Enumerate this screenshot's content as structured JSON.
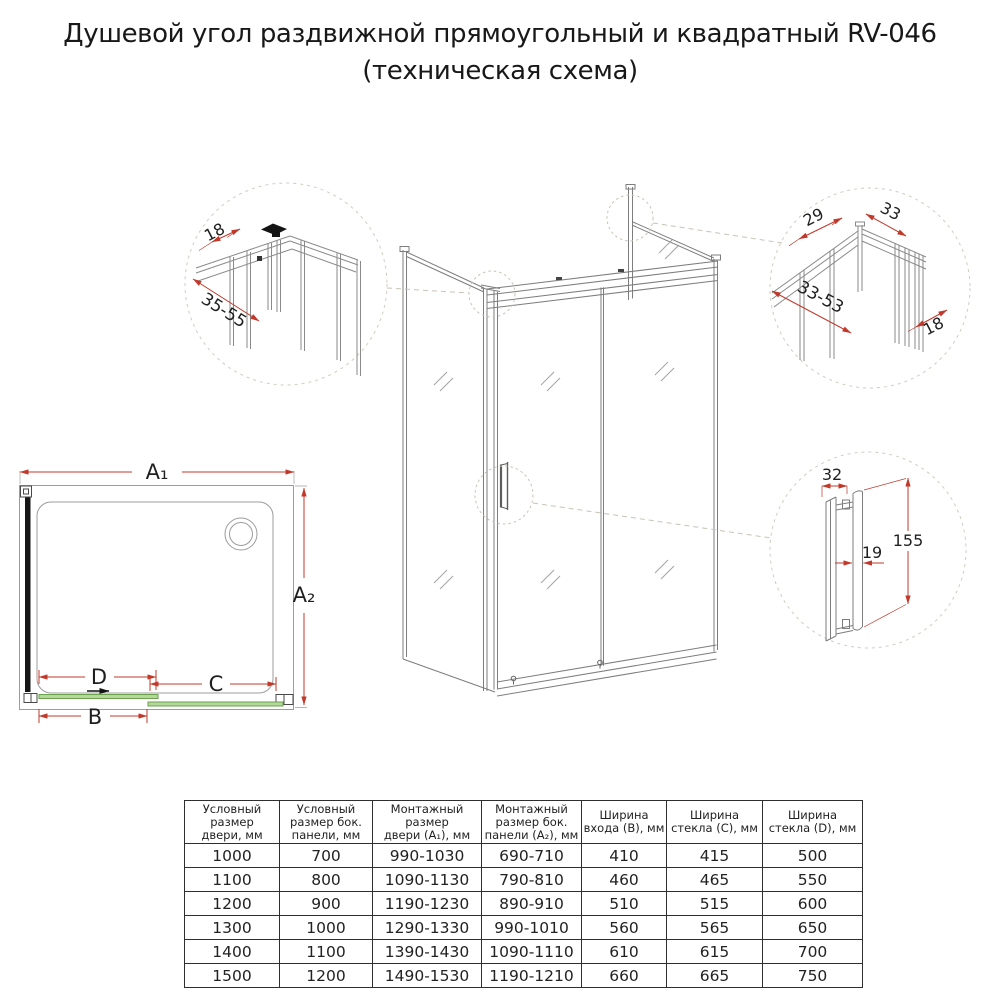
{
  "title": {
    "line1": "Душевой угол раздвижной прямоугольный и квадратный RV-046",
    "line2": "(техническая схема)"
  },
  "colors": {
    "dimension_red": "#c0392b",
    "glass_green_fill": "#b5d79c",
    "glass_green_edge": "#6aa34c",
    "drawing_line": "#7d7d7d"
  },
  "plan": {
    "dim_a1": "A₁",
    "dim_a2": "A₂",
    "dim_b": "B",
    "dim_c": "C",
    "dim_d": "D"
  },
  "detail_top_left": {
    "dim_18": "18",
    "dim_35_55": "35-55"
  },
  "detail_top_right": {
    "dim_29": "29",
    "dim_33": "33",
    "dim_33_53": "33-53",
    "dim_18": "18"
  },
  "detail_handle": {
    "dim_32": "32",
    "dim_19": "19",
    "dim_155": "155"
  },
  "table": {
    "headers": [
      "Условный\nразмер\nдвери, мм",
      "Условный\nразмер бок.\nпанели, мм",
      "Монтажный\nразмер\nдвери (А₁), мм",
      "Монтажный\nразмер бок.\nпанели (А₂), мм",
      "Ширина\nвхода (В), мм",
      "Ширина\nстекла (С), мм",
      "Ширина\nстекла (D), мм"
    ],
    "rows": [
      [
        "1000",
        "700",
        "990-1030",
        "690-710",
        "410",
        "415",
        "500"
      ],
      [
        "1100",
        "800",
        "1090-1130",
        "790-810",
        "460",
        "465",
        "550"
      ],
      [
        "1200",
        "900",
        "1190-1230",
        "890-910",
        "510",
        "515",
        "600"
      ],
      [
        "1300",
        "1000",
        "1290-1330",
        "990-1010",
        "560",
        "565",
        "650"
      ],
      [
        "1400",
        "1100",
        "1390-1430",
        "1090-1110",
        "610",
        "615",
        "700"
      ],
      [
        "1500",
        "1200",
        "1490-1530",
        "1190-1210",
        "660",
        "665",
        "750"
      ]
    ]
  }
}
